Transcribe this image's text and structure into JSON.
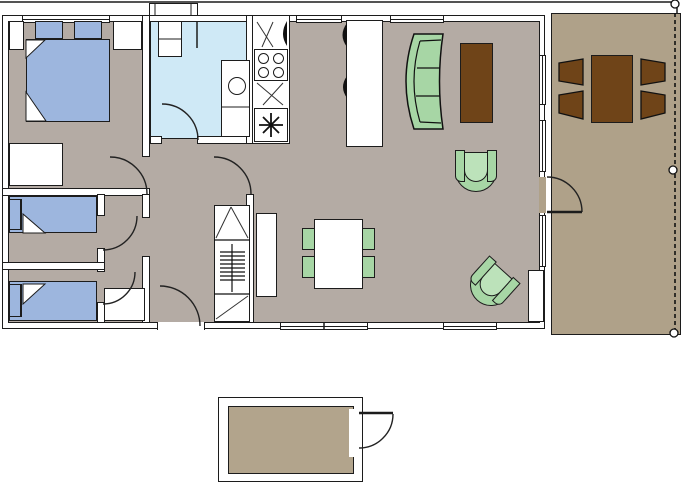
{
  "title": "Holiday home floor plan with deck and storage shed",
  "colors": {
    "wall": "#ffffff",
    "outline": "#1c1c1c",
    "floor": "#b4aba4",
    "bathroom_floor": "#cfe9f6",
    "bed_blue": "#9db6de",
    "furniture_green": "#a7d6a5",
    "green_seat": "#bce2ba",
    "deck_floor": "#afa189",
    "shed_floor": "#b2a48c",
    "wood_brown": "#6f4418"
  },
  "rooms": [
    {
      "id": "master-bedroom",
      "label": "Master bedroom",
      "furniture": [
        "double bed",
        "two pillows",
        "two nightstands",
        "dresser"
      ]
    },
    {
      "id": "bedroom-2",
      "label": "Bedroom 2",
      "furniture": [
        "single bed"
      ]
    },
    {
      "id": "bedroom-3",
      "label": "Bedroom 3",
      "furniture": [
        "single bed",
        "wardrobe"
      ]
    },
    {
      "id": "bathroom",
      "label": "Bathroom",
      "furniture": [
        "shower unit",
        "wash basin"
      ]
    },
    {
      "id": "kitchen",
      "label": "Kitchen",
      "furniture": [
        "stove with 4 burners",
        "counter",
        "island unit"
      ]
    },
    {
      "id": "hallway",
      "label": "Hallway",
      "furniture": [
        "utility cabinet",
        "water heater"
      ]
    },
    {
      "id": "living-room",
      "label": "Living and dining room",
      "furniture": [
        "curved sofa",
        "two armchairs",
        "media table",
        "sideboard",
        "dining table",
        "four dining chairs"
      ]
    },
    {
      "id": "deck",
      "label": "Deck",
      "furniture": [
        "outdoor table",
        "four outdoor chairs",
        "railing with posts"
      ]
    },
    {
      "id": "shed",
      "label": "Storage shed",
      "furniture": [
        "outward swinging door"
      ]
    }
  ],
  "counts": {
    "stove_burners": 4,
    "dining_chairs": 4,
    "deck_chairs": 4,
    "railing_posts": 3,
    "door_arcs": 8,
    "windows": 8
  }
}
